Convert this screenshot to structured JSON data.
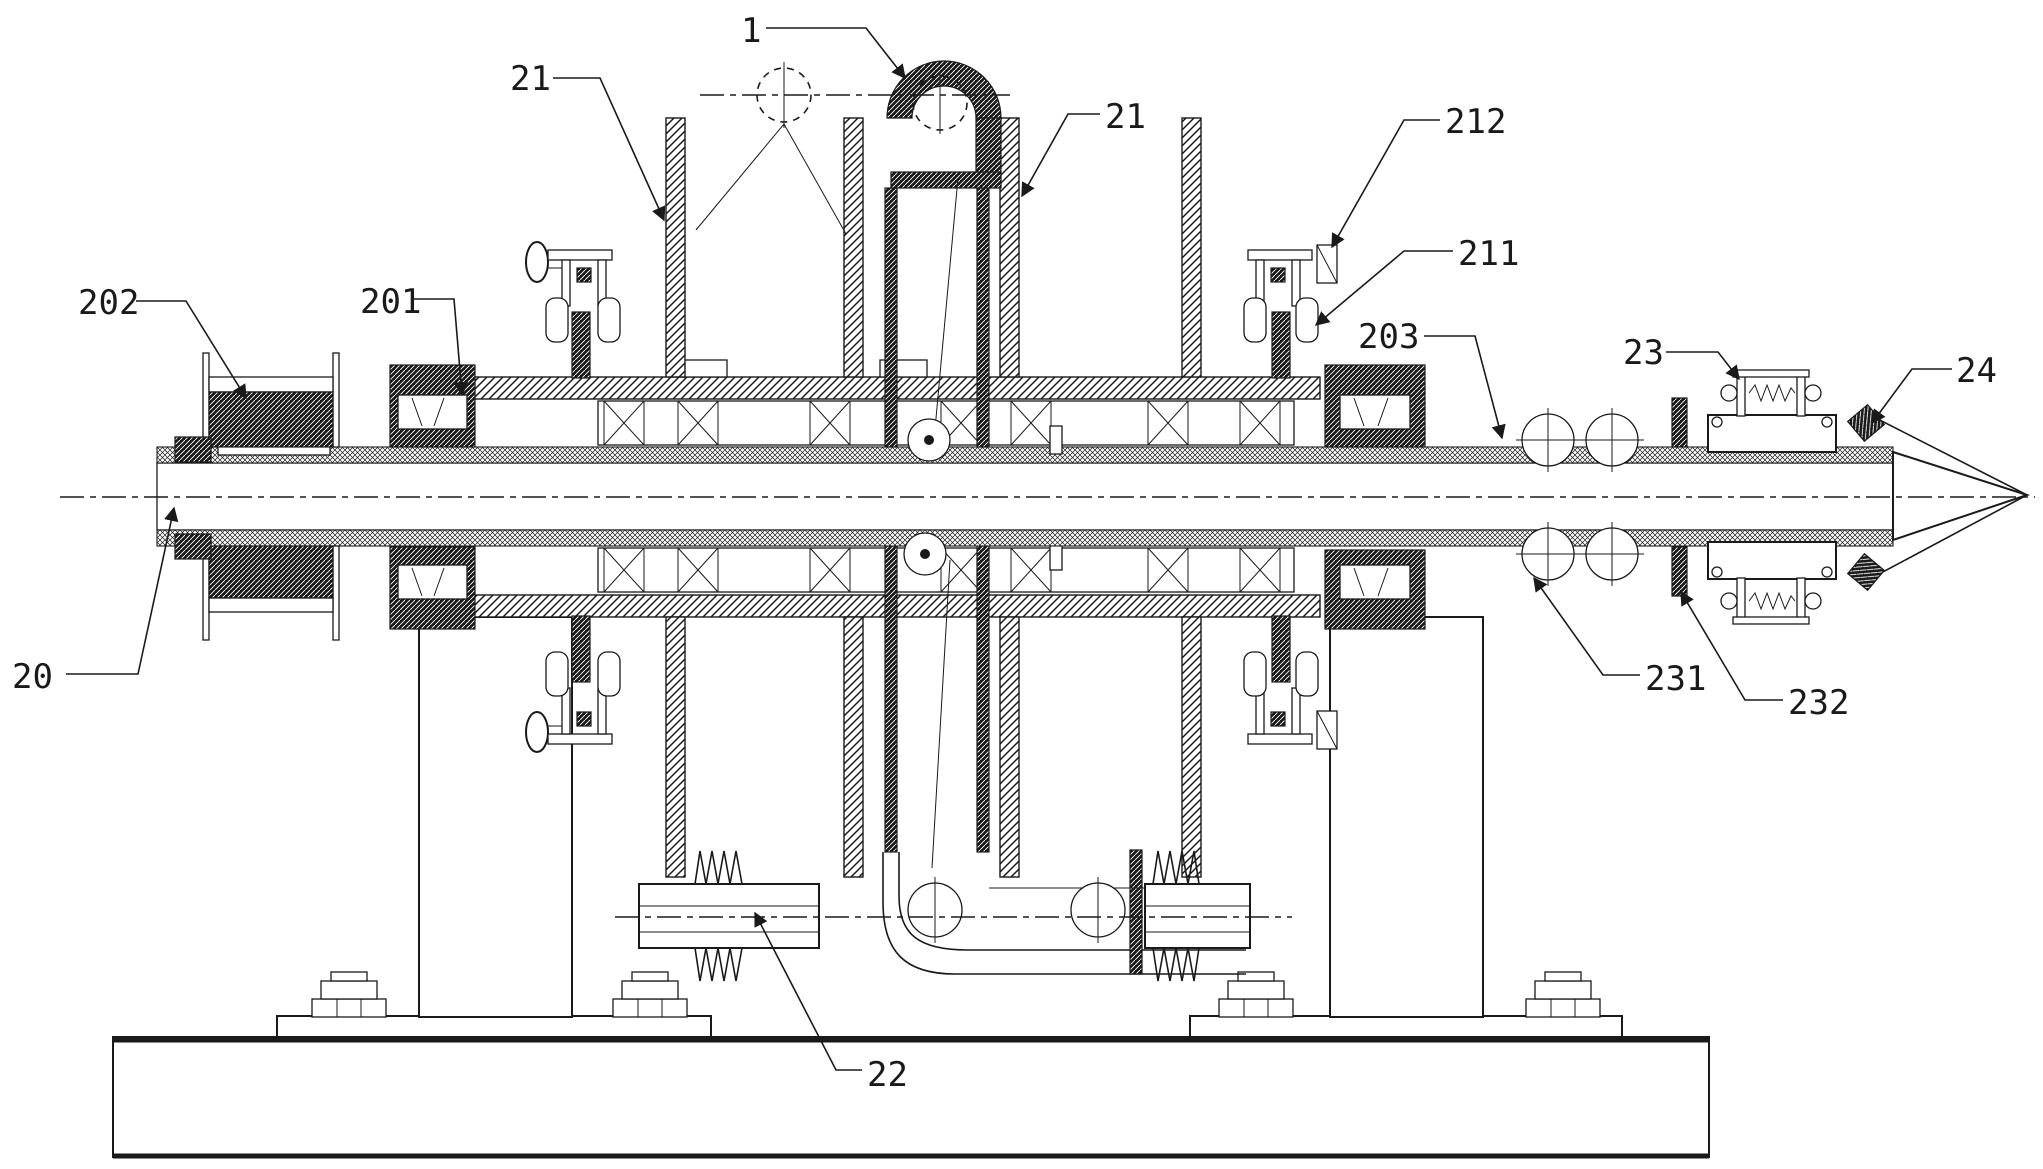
{
  "figure": {
    "type": "patent-mechanical-section-drawing",
    "background_color": "#ffffff",
    "line_color": "#1a1a1a",
    "width_px": 2043,
    "height_px": 1169
  },
  "labels": [
    {
      "id": "1",
      "text": "1",
      "x": 741,
      "y": 42,
      "leader": [
        [
          766,
          28
        ],
        [
          866,
          28
        ],
        [
          905,
          78
        ]
      ]
    },
    {
      "id": "21-left",
      "text": "21",
      "x": 510,
      "y": 90,
      "leader": [
        [
          553,
          78
        ],
        [
          600,
          78
        ],
        [
          664,
          220
        ]
      ]
    },
    {
      "id": "21-right",
      "text": "21",
      "x": 1105,
      "y": 128,
      "leader": [
        [
          1100,
          114
        ],
        [
          1068,
          114
        ],
        [
          1022,
          196
        ]
      ]
    },
    {
      "id": "212",
      "text": "212",
      "x": 1445,
      "y": 133,
      "leader": [
        [
          1440,
          120
        ],
        [
          1404,
          120
        ],
        [
          1332,
          247
        ]
      ]
    },
    {
      "id": "211",
      "text": "211",
      "x": 1458,
      "y": 265,
      "leader": [
        [
          1453,
          251
        ],
        [
          1404,
          251
        ],
        [
          1316,
          325
        ]
      ]
    },
    {
      "id": "203",
      "text": "203",
      "x": 1358,
      "y": 348,
      "leader": [
        [
          1424,
          336
        ],
        [
          1475,
          336
        ],
        [
          1502,
          438
        ]
      ]
    },
    {
      "id": "202",
      "text": "202",
      "x": 78,
      "y": 314,
      "leader": [
        [
          136,
          301
        ],
        [
          186,
          301
        ],
        [
          246,
          398
        ]
      ]
    },
    {
      "id": "201",
      "text": "201",
      "x": 360,
      "y": 313,
      "leader": [
        [
          414,
          299
        ],
        [
          454,
          299
        ],
        [
          462,
          395
        ]
      ]
    },
    {
      "id": "20",
      "text": "20",
      "x": 12,
      "y": 688,
      "leader": [
        [
          66,
          674
        ],
        [
          138,
          674
        ],
        [
          174,
          508
        ]
      ]
    },
    {
      "id": "22",
      "text": "22",
      "x": 867,
      "y": 1086,
      "leader": [
        [
          862,
          1070
        ],
        [
          836,
          1070
        ],
        [
          755,
          913
        ]
      ]
    },
    {
      "id": "23",
      "text": "23",
      "x": 1623,
      "y": 364,
      "leader": [
        [
          1666,
          352
        ],
        [
          1718,
          352
        ],
        [
          1739,
          379
        ]
      ]
    },
    {
      "id": "24",
      "text": "24",
      "x": 1956,
      "y": 382,
      "leader": [
        [
          1952,
          369
        ],
        [
          1912,
          369
        ],
        [
          1872,
          423
        ]
      ]
    },
    {
      "id": "231",
      "text": "231",
      "x": 1645,
      "y": 690,
      "leader": [
        [
          1640,
          675
        ],
        [
          1603,
          675
        ],
        [
          1534,
          578
        ]
      ]
    },
    {
      "id": "232",
      "text": "232",
      "x": 1788,
      "y": 714,
      "leader": [
        [
          1783,
          700
        ],
        [
          1745,
          700
        ],
        [
          1681,
          592
        ]
      ]
    }
  ]
}
